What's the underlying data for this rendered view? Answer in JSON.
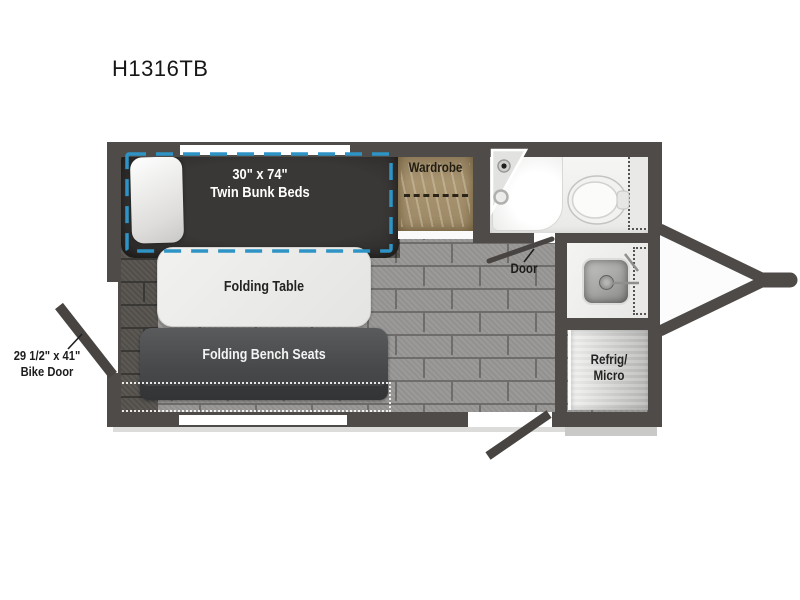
{
  "page": {
    "title": "H1316TB"
  },
  "plan": {
    "bunks": {
      "line1": "30\" x 74\"",
      "line2": "Twin Bunk Beds"
    },
    "wardrobe": {
      "label": "Wardrobe"
    },
    "door": {
      "label": "Door"
    },
    "table": {
      "label": "Folding Table"
    },
    "bench": {
      "label": "Folding Bench Seats"
    },
    "refrig": {
      "line1": "Refrig/",
      "line2": "Micro"
    },
    "bike_door": {
      "line1": "29 1/2\" x 41\"",
      "line2": "Bike Door"
    },
    "colors": {
      "wall": "#4f4b49",
      "accent_dash": "#2e94c5",
      "bed": "#343230",
      "wardrobe_wood": "#a5906c",
      "floor_light": "#989694",
      "floor_dark": "#55524e"
    }
  }
}
